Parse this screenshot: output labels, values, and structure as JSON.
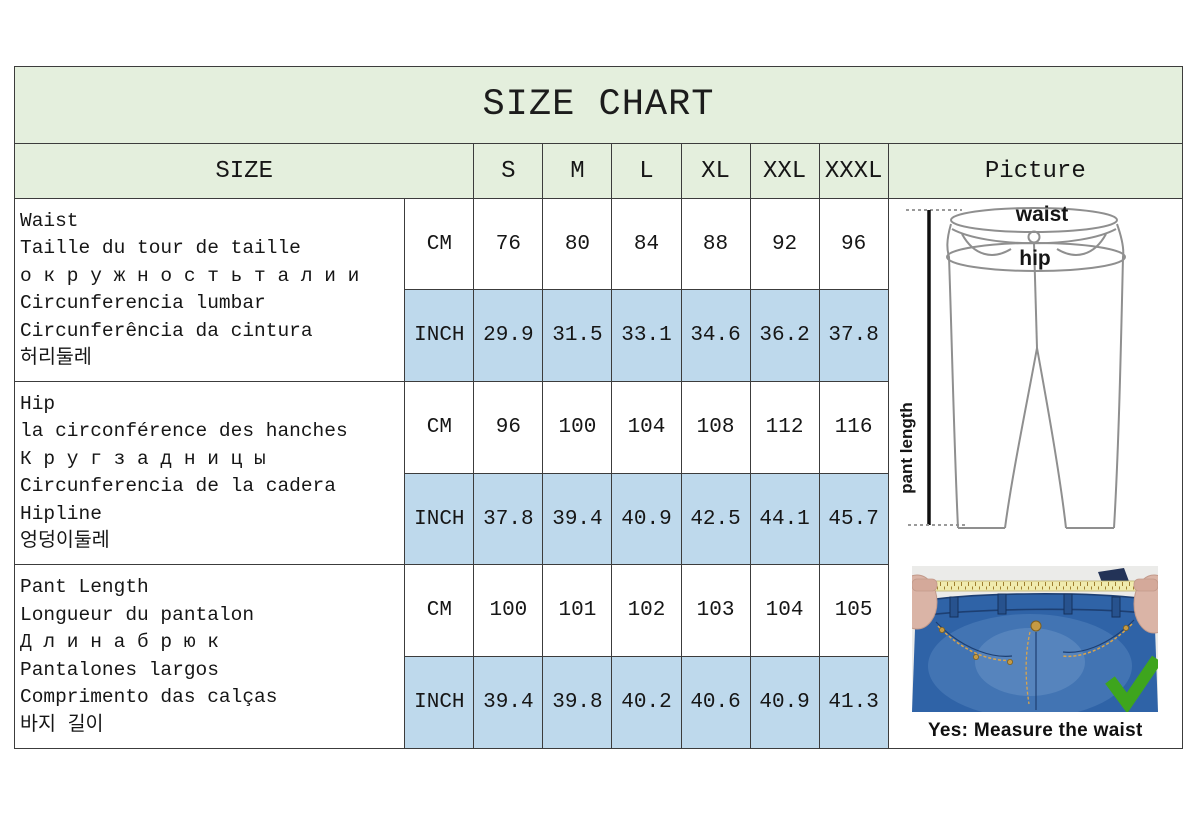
{
  "title": "SIZE CHART",
  "colors": {
    "header_green": "#e4efdd",
    "inch_row_blue": "#bed9ec",
    "grid_border": "#3c3c3c",
    "denim_blue": "#2f63a7",
    "tape_yellow": "#f0ebae",
    "check_green": "#3ea51d"
  },
  "table": {
    "size_header": "SIZE",
    "picture_header": "Picture",
    "sizes": [
      "S",
      "M",
      "L",
      "XL",
      "XXL",
      "XXXL"
    ],
    "rows": [
      {
        "measure": "Waist",
        "label_lines": [
          "Waist",
          "Taille du tour de taille",
          "о к р у ж н о с т ь  т а л и и",
          "Circunferencia lumbar",
          "Circunferência da cintura",
          "허리둘레"
        ],
        "cm_unit": "CM",
        "cm_values": [
          "76",
          "80",
          "84",
          "88",
          "92",
          "96"
        ],
        "inch_unit": "INCH",
        "inch_values": [
          "29.9",
          "31.5",
          "33.1",
          "34.6",
          "36.2",
          "37.8"
        ]
      },
      {
        "measure": "Hip",
        "label_lines": [
          "Hip",
          "la circonférence des hanches",
          "К р у г  з а д н и ц ы",
          "Circunferencia de la cadera",
          "Hipline",
          "엉덩이둘레"
        ],
        "cm_unit": "CM",
        "cm_values": [
          "96",
          "100",
          "104",
          "108",
          "112",
          "116"
        ],
        "inch_unit": "INCH",
        "inch_values": [
          "37.8",
          "39.4",
          "40.9",
          "42.5",
          "44.1",
          "45.7"
        ]
      },
      {
        "measure": "Pant Length",
        "label_lines": [
          "Pant Length",
          "Longueur du pantalon",
          "Д л и н а  б р ю к",
          "Pantalones largos",
          "Comprimento das calças",
          "바지 길이"
        ],
        "cm_unit": "CM",
        "cm_values": [
          "100",
          "101",
          "102",
          "103",
          "104",
          "105"
        ],
        "inch_unit": "INCH",
        "inch_values": [
          "39.4",
          "39.8",
          "40.2",
          "40.6",
          "40.9",
          "41.3"
        ]
      }
    ]
  },
  "picture": {
    "diagram_labels": {
      "waist": "waist",
      "hip": "hip",
      "pant_length": "pant length"
    },
    "photo_caption": "Yes: Measure the waist"
  }
}
